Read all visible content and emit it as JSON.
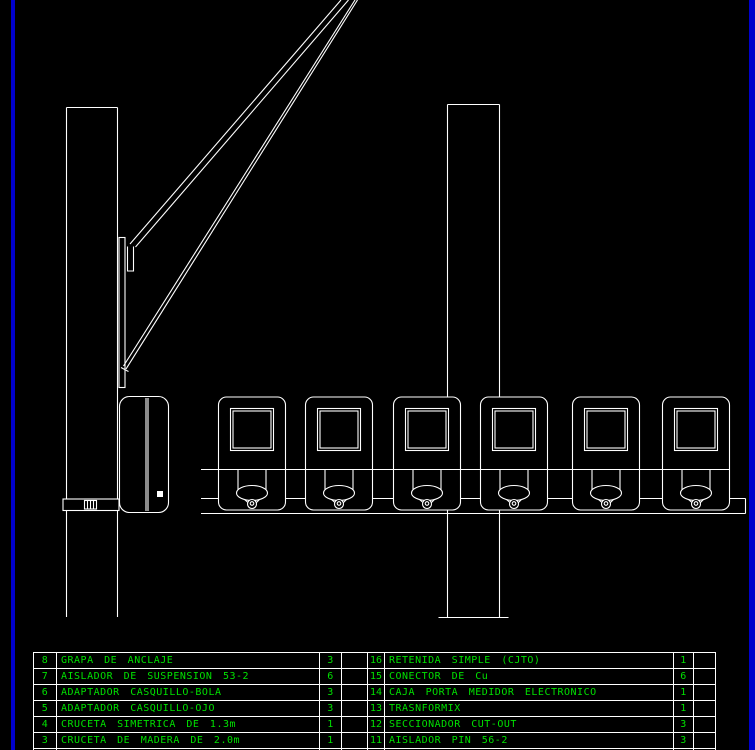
{
  "colors": {
    "background": "#000000",
    "drawing_line": "#ffffff",
    "text_green": "#00e100",
    "frame_blue": "#0000cc"
  },
  "drawing": {
    "elements": [
      "utility-pole-left",
      "utility-pole-right",
      "guy-wire-upper",
      "guy-wire-lower",
      "anchor-strip",
      "mounting-bracket",
      "meter-side-view",
      "meter-front-row",
      "meter-rail"
    ],
    "front_meter_count": 6
  },
  "tables": {
    "left": {
      "rows": [
        {
          "num": "8",
          "desc": "GRAPA DE ANCLAJE",
          "qty": "3"
        },
        {
          "num": "7",
          "desc": "AISLADOR DE SUSPENSION 53-2",
          "qty": "6"
        },
        {
          "num": "6",
          "desc": "ADAPTADOR CASQUILLO-BOLA",
          "qty": "3"
        },
        {
          "num": "5",
          "desc": "ADAPTADOR CASQUILLO-OJO",
          "qty": "3"
        },
        {
          "num": "4",
          "desc": "CRUCETA SIMETRICA DE 1.3m",
          "qty": "1"
        },
        {
          "num": "3",
          "desc": "CRUCETA DE MADERA DE 2.0m",
          "qty": "1"
        }
      ]
    },
    "right": {
      "rows": [
        {
          "num": "16",
          "desc": "RETENIDA SIMPLE (CJTO)",
          "qty": "1"
        },
        {
          "num": "15",
          "desc": "CONECTOR DE Cu",
          "qty": "6"
        },
        {
          "num": "14",
          "desc": "CAJA PORTA MEDIDOR ELECTRONICO",
          "qty": "1"
        },
        {
          "num": "13",
          "desc": "TRASNFORMIX",
          "qty": "1"
        },
        {
          "num": "12",
          "desc": "SECCIONADOR CUT-OUT",
          "qty": "3"
        },
        {
          "num": "11",
          "desc": "AISLADOR PIN 56-2",
          "qty": "3"
        }
      ]
    }
  }
}
